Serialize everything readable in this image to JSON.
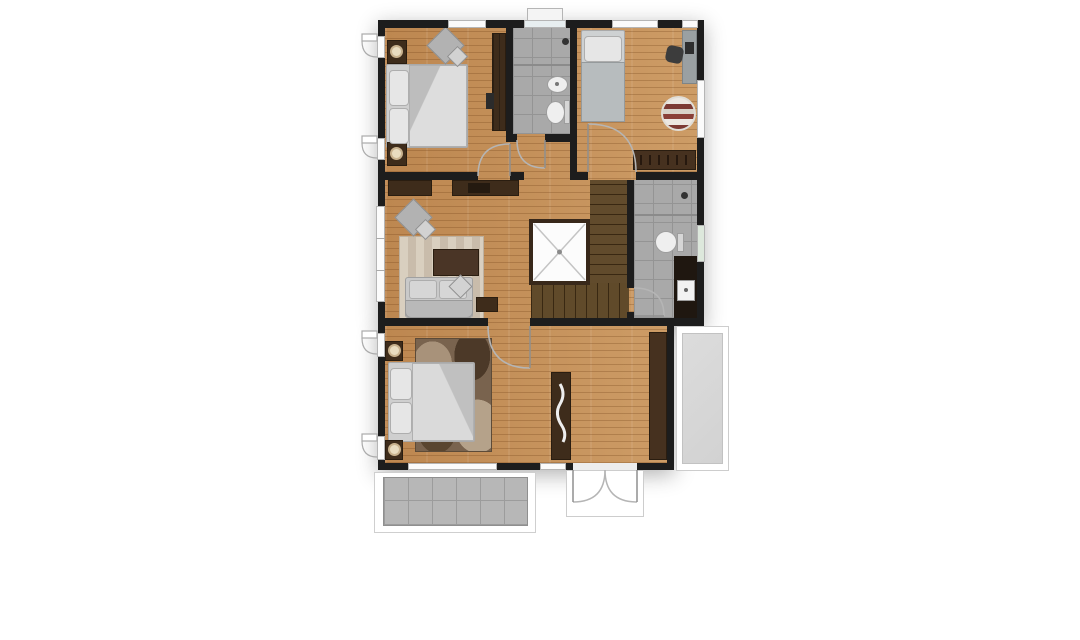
{
  "image_type": "architectural floor plan, top-down render, no text labels",
  "palette": {
    "background": "#ffffff",
    "wall": "#1d1d1d",
    "wood_floor": "#c6915a",
    "dark_wood_furniture": "#3e2c1b",
    "stair_wood": "#57401f",
    "bathroom_tile": "#a9a9a9",
    "terrace_tile": "#b7b7b7",
    "balcony": "#d9d9d9",
    "fabric_gray": "#c9c9c9",
    "lamp_cream": "#e9dcc0",
    "rug_stripe_red": "#7c3a34",
    "door_swing_line": "#b5b5b5"
  },
  "rooms": [
    {
      "id": "bedroom-top-left",
      "floor": "wood",
      "furniture": [
        "double-bed",
        "nightstand-with-lamp-top",
        "nightstand-with-lamp-bottom",
        "diamond-lounge-chair",
        "wardrobe",
        "wall-tv"
      ]
    },
    {
      "id": "bathroom-top",
      "floor": "gray-tile",
      "fixtures": [
        "shower-area",
        "divider",
        "oval-sink",
        "toilet",
        "window-top"
      ]
    },
    {
      "id": "bedroom-top-right",
      "floor": "wood",
      "furniture": [
        "single-bed",
        "desk",
        "desk-chair",
        "round-striped-rug",
        "dresser-with-drawers"
      ]
    },
    {
      "id": "living-hall",
      "floor": "wood",
      "furniture": [
        "tv-console-left",
        "tv-console-right",
        "diamond-armchair",
        "striped-area-rug",
        "coffee-table",
        "sofa",
        "side-table"
      ]
    },
    {
      "id": "stairwell",
      "floor": "dark-wood",
      "elements": [
        "open-void-with-x",
        "stair-flight-treads",
        "landing-steps"
      ]
    },
    {
      "id": "bathroom-middle",
      "floor": "gray-tile",
      "fixtures": [
        "shower-area",
        "divider",
        "toilet",
        "vanity-counter",
        "square-sink",
        "window-right"
      ]
    },
    {
      "id": "master-bedroom",
      "floor": "wood",
      "furniture": [
        "double-bed",
        "nightstand-with-lamp-top",
        "nightstand-with-lamp-bottom",
        "patterned-rug",
        "decor-console",
        "wardrobe"
      ]
    },
    {
      "id": "balcony-right",
      "floor": "light-gray"
    },
    {
      "id": "terrace-bottom",
      "floor": "gray-tile-grid"
    }
  ],
  "doors": [
    "bedroom-top-left-door",
    "bathroom-top-door",
    "bedroom-top-right-door",
    "master-bedroom-door",
    "bathroom-middle-door",
    "exterior-double-door-bottom"
  ],
  "windows": [
    "top-wall-window-left",
    "top-wall-window-center-with-sill",
    "top-wall-window-right",
    "top-wall-window-corner",
    "left-casement-1",
    "left-casement-2",
    "left-living-window",
    "left-casement-3",
    "left-casement-4",
    "right-bedroom-window",
    "right-bathroom-window",
    "bottom-window-long",
    "bottom-window-short"
  ]
}
